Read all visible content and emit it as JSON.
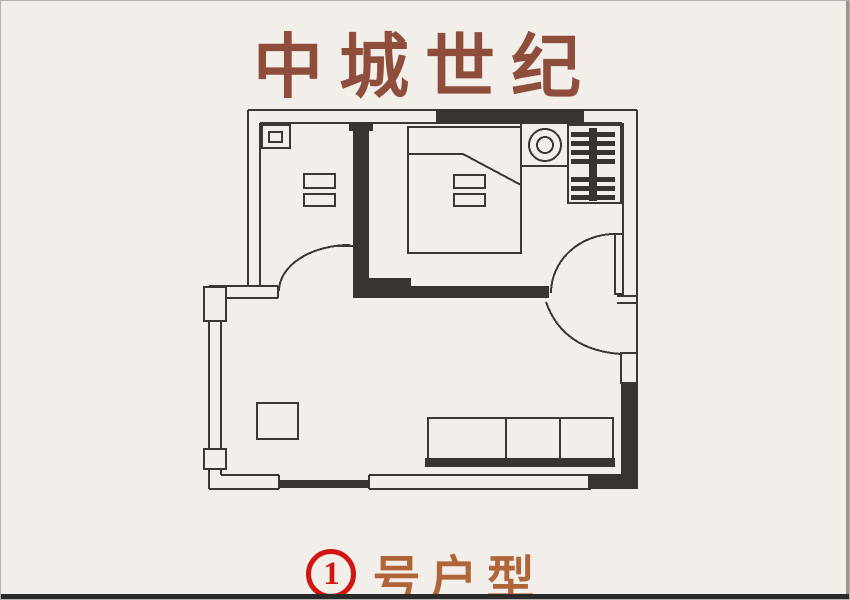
{
  "title": "中城世纪",
  "caption": {
    "unit_number": "1",
    "label": "号户型"
  },
  "colors": {
    "title_text": "#8e4e3b",
    "caption_label": "#b06538",
    "unit_badge_red": "#d11510",
    "plan_line": "#3c3733",
    "wall_fill": "#3a3430",
    "background": "#f2efeb"
  },
  "floor_plan": {
    "icons": [
      "outer-walls",
      "interior-wall",
      "window-left",
      "window-bottom",
      "door-left-room",
      "door-bedroom",
      "door-entry",
      "bed",
      "pillow",
      "nightstand",
      "exhaust-fan",
      "radiator",
      "duct-box",
      "coffee-table",
      "sofa"
    ]
  }
}
